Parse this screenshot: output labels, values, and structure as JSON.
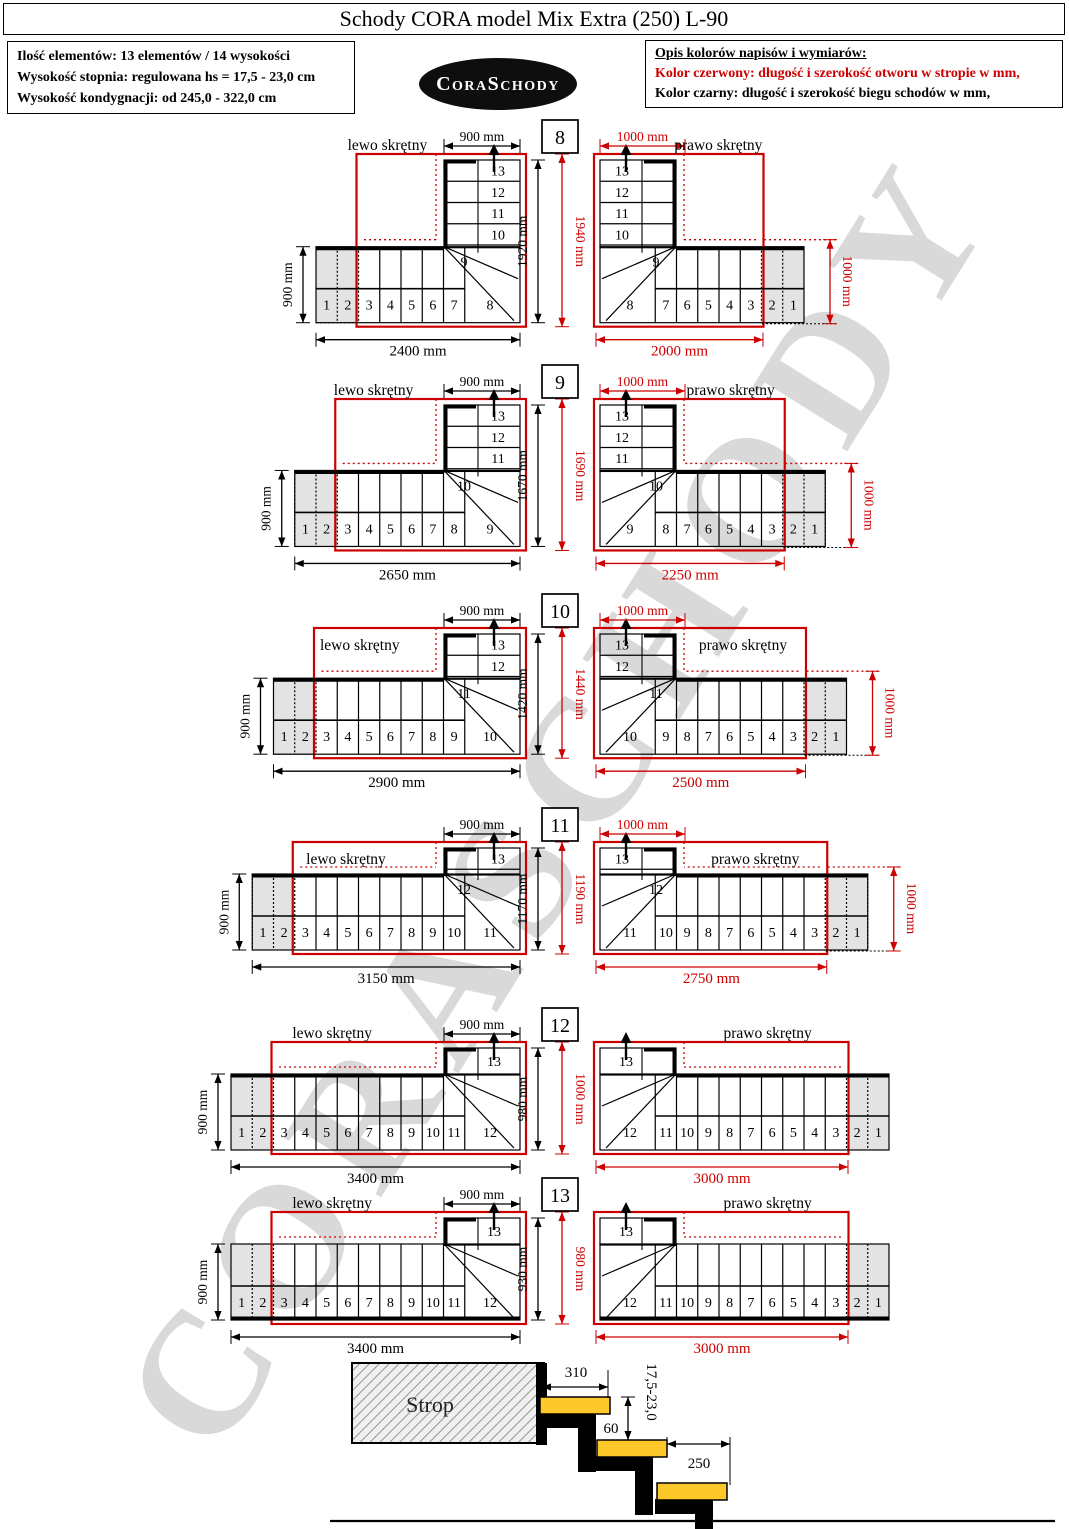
{
  "title": "Schody CORA model Mix Extra (250) L-90",
  "info_box": {
    "lines": [
      "Ilość elementów: 13 elementów / 14 wysokości",
      "Wysokość stopnia: regulowana  hs = 17,5 - 23,0 cm",
      "Wysokość kondygnacji: od 245,0 - 322,0 cm"
    ]
  },
  "logo_text": "CoraSchody",
  "legend": {
    "heading": "Opis kolorów napisów i wymiarów:",
    "red_line": "Kolor czerwony:  długość i szerokość otworu w stropie w mm,",
    "black_line": "Kolor czarny:  długość i szerokość biegu schodów w mm,"
  },
  "watermark": "CORASCHODY",
  "colors": {
    "accent_red": "#cc0000",
    "line_black": "#000000",
    "gray_step_fill": "#e3e3e3",
    "tread_yellow": "#fdc82a",
    "logo_bg": "#0e0e0e",
    "watermark_gray": "#d9d9d9"
  },
  "rows": [
    {
      "number": "8",
      "run_black": "1920 mm",
      "run_red": "1940 mm",
      "left": {
        "label": "lewo skrętny",
        "top_dim": "900 mm",
        "side_dim": "900 mm",
        "bottom_dim": "2400 mm"
      },
      "right": {
        "label": "prawo skrętny",
        "top_dim": "1000 mm",
        "side_dim": "1000 mm",
        "bottom_dim": "2000 mm"
      },
      "bottom_steps": [
        "1",
        "2",
        "3",
        "4",
        "5",
        "6",
        "7",
        "8"
      ],
      "upper_steps": [
        "13",
        "12",
        "11",
        "10",
        "9"
      ]
    },
    {
      "number": "9",
      "run_black": "1670 mm",
      "run_red": "1690 mm",
      "left": {
        "label": "lewo skrętny",
        "top_dim": "900 mm",
        "side_dim": "900 mm",
        "bottom_dim": "2650 mm"
      },
      "right": {
        "label": "prawo skrętny",
        "top_dim": "1000 mm",
        "side_dim": "1000 mm",
        "bottom_dim": "2250 mm"
      },
      "bottom_steps": [
        "1",
        "2",
        "3",
        "4",
        "5",
        "6",
        "7",
        "8",
        "9"
      ],
      "upper_steps": [
        "13",
        "12",
        "11",
        "10"
      ]
    },
    {
      "number": "10",
      "run_black": "1420 mm",
      "run_red": "1440 mm",
      "left": {
        "label": "lewo skrętny",
        "top_dim": "900 mm",
        "side_dim": "900 mm",
        "bottom_dim": "2900 mm"
      },
      "right": {
        "label": "prawo skrętny",
        "top_dim": "1000 mm",
        "side_dim": "1000 mm",
        "bottom_dim": "2500 mm"
      },
      "bottom_steps": [
        "1",
        "2",
        "3",
        "4",
        "5",
        "6",
        "7",
        "8",
        "9",
        "10"
      ],
      "upper_steps": [
        "13",
        "12",
        "11"
      ]
    },
    {
      "number": "11",
      "run_black": "1170 mm",
      "run_red": "1190 mm",
      "left": {
        "label": "lewo skrętny",
        "top_dim": "900 mm",
        "side_dim": "900 mm",
        "bottom_dim": "3150 mm"
      },
      "right": {
        "label": "prawo skrętny",
        "top_dim": "1000 mm",
        "side_dim": "1000 mm",
        "bottom_dim": "2750 mm"
      },
      "bottom_steps": [
        "1",
        "2",
        "3",
        "4",
        "5",
        "6",
        "7",
        "8",
        "9",
        "10",
        "11"
      ],
      "upper_steps": [
        "13",
        "12"
      ]
    },
    {
      "number": "12",
      "run_black": "980 mm",
      "run_red": "1000 mm",
      "left": {
        "label": "lewo skrętny",
        "top_dim": "900 mm",
        "side_dim": "900 mm",
        "bottom_dim": "3400 mm"
      },
      "right": {
        "label": "prawo skrętny",
        "bottom_dim": "3000 mm"
      },
      "bottom_steps": [
        "1",
        "2",
        "3",
        "4",
        "5",
        "6",
        "7",
        "8",
        "9",
        "10",
        "11",
        "12"
      ],
      "upper_steps": [
        "13"
      ]
    },
    {
      "number": "13",
      "run_black": "930 mm",
      "run_red": "980 mm",
      "wall_edge": "bottom",
      "left": {
        "label": "lewo skrętny",
        "top_dim": "900 mm",
        "side_dim": "900 mm",
        "bottom_dim": "3400 mm"
      },
      "right": {
        "label": "prawo skrętny",
        "bottom_dim": "3000 mm"
      },
      "bottom_steps": [
        "1",
        "2",
        "3",
        "4",
        "5",
        "6",
        "7",
        "8",
        "9",
        "10",
        "11",
        "12"
      ],
      "upper_steps": [
        "13"
      ]
    }
  ],
  "section": {
    "strop_label": "Strop",
    "dim_tread_top": "310",
    "dim_riser_range": "17,5-23,0",
    "dim_overlap": "60",
    "dim_tread": "250"
  }
}
